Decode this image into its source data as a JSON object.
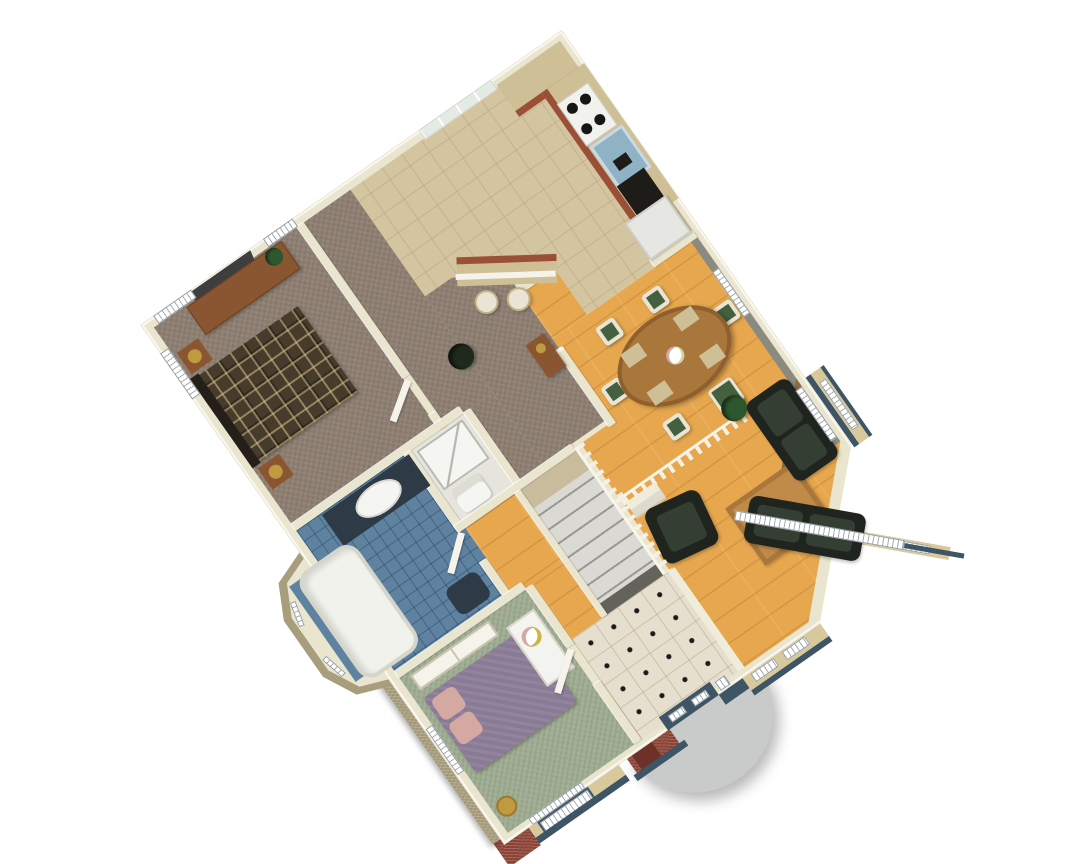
{
  "scene": {
    "type": "3d-isometric-floor-plan-rendering",
    "description": "Single-storey house floor plan shown in cutaway 3D, rotated diamond orientation on a plain white background",
    "rotation_deg": -35,
    "background": "#FFFFFF"
  },
  "palette": {
    "cream_wall": "#EAE5CE",
    "gray_wall": "#8A8A80",
    "carpet": "#8E7F72",
    "kitchen_tile": "#D4C5A1",
    "wood_floor": "#E6A74E",
    "bath_tile": "#5E82A0",
    "sage_floor": "#9FAD92",
    "entry_tile": "#E7DFCE",
    "shower_floor": "#E6E5DD",
    "stair_tread": "#DAD9D3",
    "stair_dark": "#63635C",
    "landing_tan": "#C9BC9C",
    "step_cream": "#EFECDC",
    "brick": "#8E4537",
    "brick_dark": "#6E3129",
    "khaki_brick": "#A89D7C",
    "siding": "#D8C99D",
    "slate_trim": "#3D5565",
    "concrete": "#C9CBCB",
    "sofa_green": "#1F241F",
    "cushion_green": "#343E33",
    "coffee_table": "#C08A49",
    "dining_table": "#A9763C",
    "chair_frame": "#E9E4D3",
    "chair_seat": "#44603F",
    "fireplace_wood": "#8A6A44",
    "firebox_black": "#140E08",
    "counter_top": "#9A5036",
    "cabinet_tan": "#CFBF96",
    "stove_white": "#F1F1ED",
    "burner_black": "#161616",
    "sink_steel": "#8FB2C4",
    "appliance_black": "#1E1C19",
    "fridge_white": "#E6E7E3",
    "vanity_navy": "#2E3A46",
    "porcelain_white": "#F5F5F1",
    "tub_white": "#F2F2EC",
    "bed_plaid": "#473B2B",
    "headboard_dark": "#241F19",
    "dresser_wood": "#8A5631",
    "tv_dark": "#3E3E3E",
    "bed_purple": "#897A95",
    "pillow_pink": "#D3A9A2",
    "desk_white": "#F3F3EF",
    "door_white": "#F5F3EA",
    "plant_green": "#2D572D",
    "plant_dark": "#1F291D",
    "lamp_gold": "#C09A3E",
    "window_white": "#FFFFFF",
    "glass_pane": "#E4EAE4",
    "railing_white": "#F4F1E4"
  },
  "rooms": [
    {
      "id": "master-bedroom",
      "floor": "carpet",
      "contents": [
        "plaid-bed",
        "headboard",
        "nightstand x2",
        "gold-lamp x2",
        "dresser",
        "tv",
        "plant",
        "windows x3"
      ]
    },
    {
      "id": "kitchen",
      "floor": "kitchen_tile",
      "contents": [
        "sliding-patio-door",
        "wall-cabinets",
        "base-cabinets",
        "stove",
        "sink",
        "dishwasher",
        "refrigerator",
        "breakfast-bar",
        "bar-stool x2"
      ]
    },
    {
      "id": "dining-room",
      "floor": "wood_floor",
      "contents": [
        "oval-table",
        "chair x6",
        "centerpiece-flowers",
        "sideboard-with-gold-pot",
        "railing",
        "corner-fireplace",
        "potted-plant",
        "window"
      ]
    },
    {
      "id": "living-room",
      "floor": "wood_floor",
      "contents": [
        "sofa x2",
        "armchair",
        "coffee-table-with-plant",
        "bay-windows",
        "window"
      ]
    },
    {
      "id": "bathroom",
      "floor": "bath_tile",
      "contents": [
        "navy-vanity",
        "oval-sink",
        "bathtub-in-bay",
        "toilet",
        "bay-windows"
      ]
    },
    {
      "id": "shower-room",
      "floor": "shower_floor",
      "contents": [
        "shower-stall",
        "toilet"
      ]
    },
    {
      "id": "bedroom-2",
      "floor": "sage_floor",
      "contents": [
        "purple-bed",
        "pink-pillows x2",
        "closet",
        "white-desk-with-flowers",
        "gold-side-table",
        "windows x2",
        "door"
      ]
    },
    {
      "id": "entry-foyer",
      "floor": "entry_tile",
      "contents": [
        "front-door",
        "sidelight",
        "tile-with-black-diamond-dots"
      ]
    },
    {
      "id": "hallway",
      "floor": "carpet",
      "contents": [
        "potted-plant"
      ]
    },
    {
      "id": "stairs",
      "floor": "stair_tread",
      "contents": [
        "landing",
        "treads-down",
        "railing"
      ]
    }
  ],
  "exterior": {
    "features": [
      "red-brick-accents",
      "khaki-brick-veneer",
      "tan-siding",
      "slate-blue-trim",
      "living-room-bay-window",
      "bathroom-bay-window",
      "semicircular-concrete-stoop",
      "slate-blue-front-door"
    ]
  }
}
